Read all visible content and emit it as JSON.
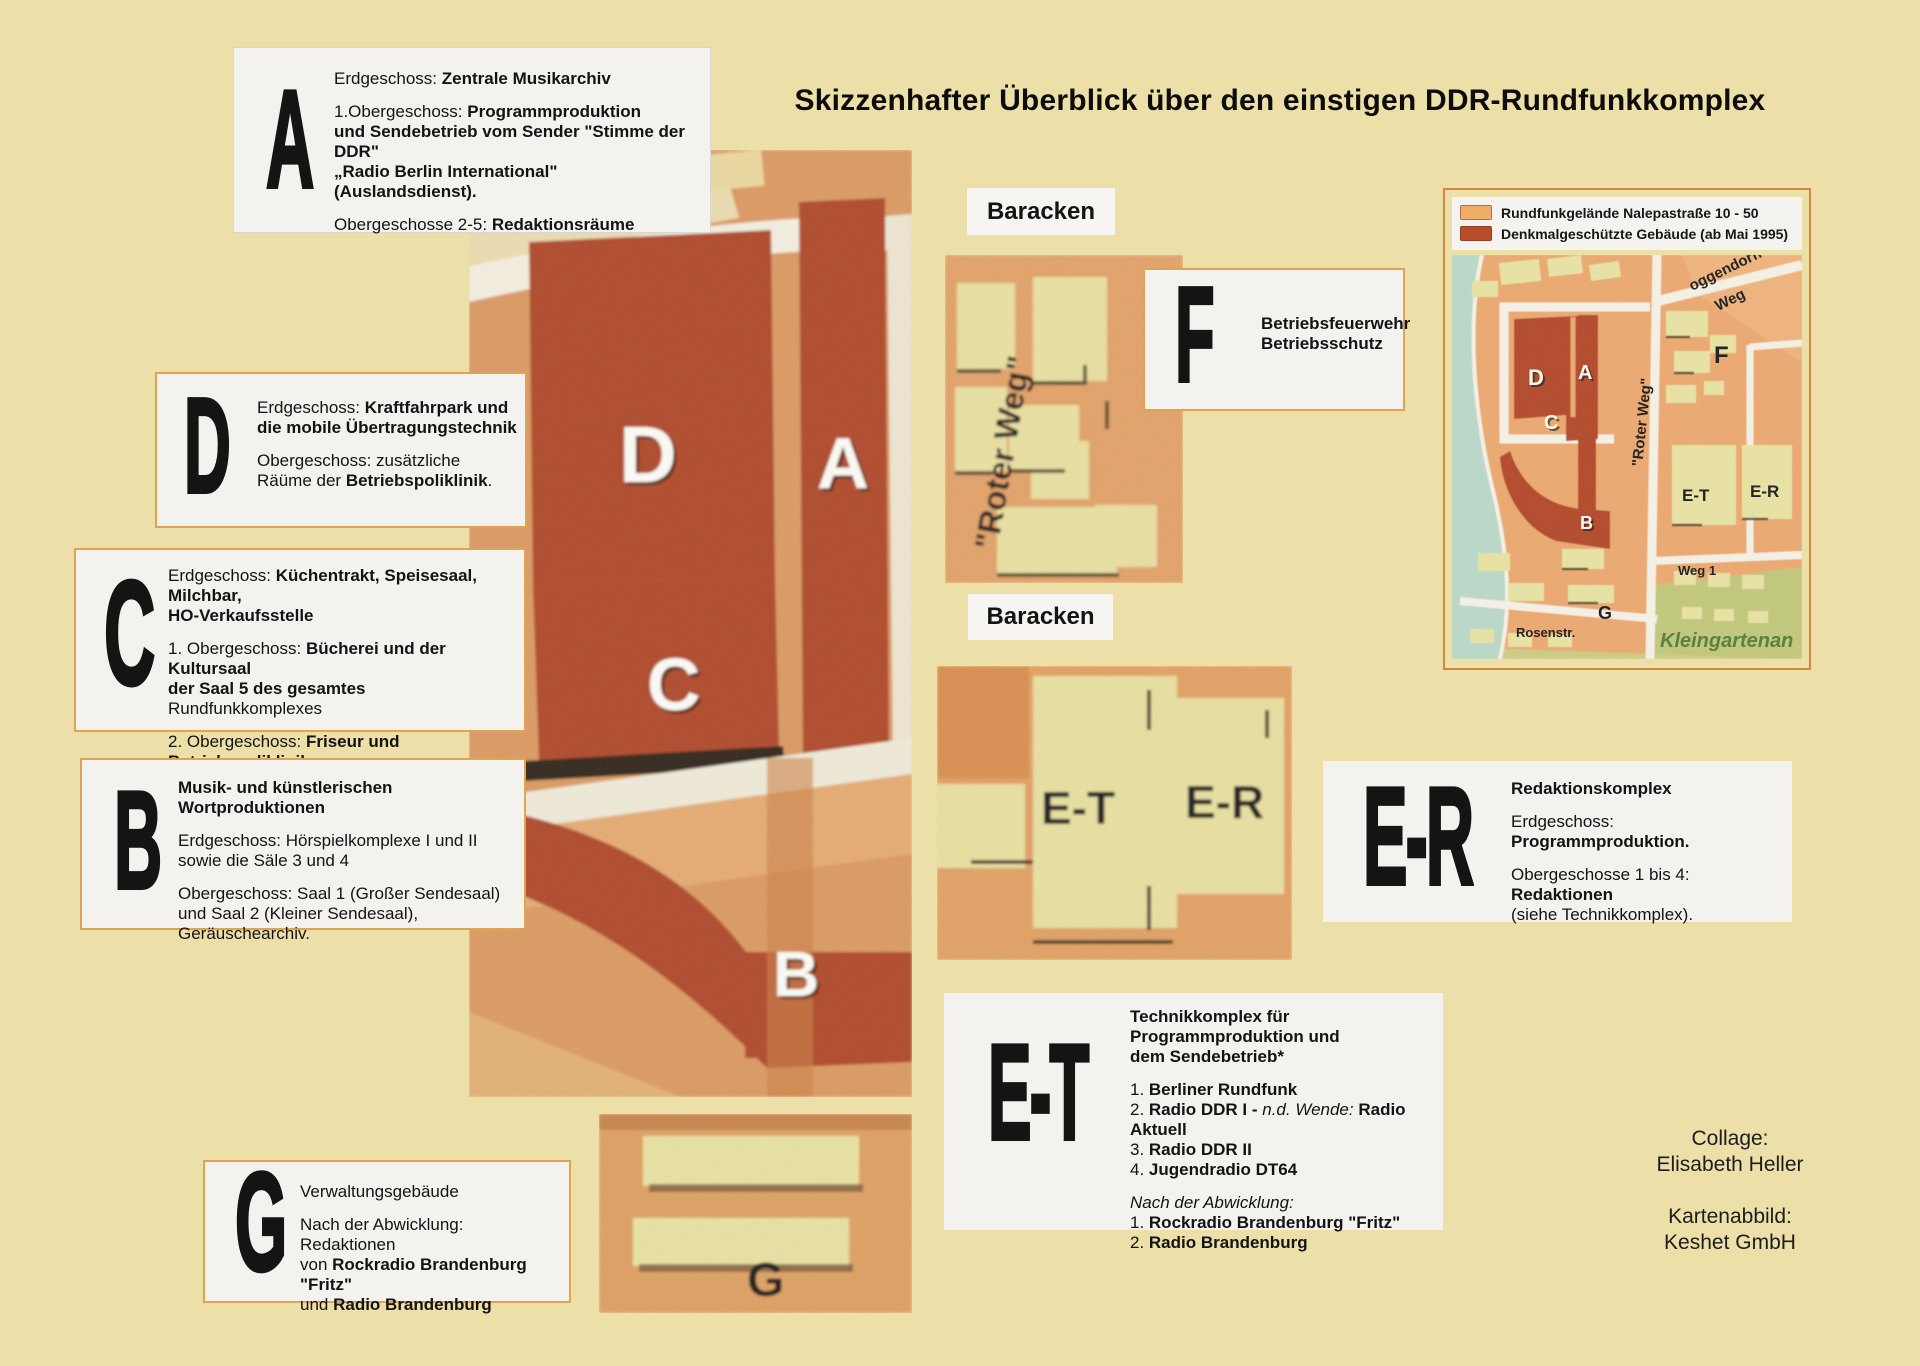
{
  "title": "Skizzenhafter Überblick über den einstigen DDR-Rundfunkkomplex",
  "colors": {
    "page_background": "#ecdfa8",
    "box_background": "#f3f2ee",
    "box_border_orange": "#dfa452",
    "map_orange": "#dc9a62",
    "building_red": "#b04a29",
    "building_yellow": "#e9e0a0",
    "water": "#bad9c9",
    "green_area": "#c3c87c"
  },
  "boxes": {
    "a": {
      "letter": "A",
      "paragraphs": [
        [
          [
            {
              "t": "Erdgeschoss: "
            },
            {
              "t": "Zentrale Musikarchiv",
              "b": true
            }
          ]
        ],
        [
          [
            {
              "t": "1.Obergeschoss: "
            },
            {
              "t": "Programmproduktion",
              "b": true
            }
          ],
          [
            {
              "t": "und Sendebetrieb vom Sender \"Stimme der DDR\"",
              "b": true
            }
          ],
          [
            {
              "t": " „Radio Berlin International\" (Auslandsdienst).",
              "b": true
            }
          ]
        ],
        [
          [
            {
              "t": "Obergeschosse 2-5: "
            },
            {
              "t": "Redaktionsräume",
              "b": true
            }
          ]
        ]
      ]
    },
    "d": {
      "letter": "D",
      "paragraphs": [
        [
          [
            {
              "t": "Erdgeschoss: "
            },
            {
              "t": "Kraftfahrpark und",
              "b": true
            }
          ],
          [
            {
              "t": "die mobile Übertragungstechnik",
              "b": true
            }
          ]
        ],
        [
          [
            {
              "t": "Obergeschoss: zusätzliche"
            }
          ],
          [
            {
              "t": "Räüme der "
            },
            {
              "t": "Betriebspoliklinik",
              "b": true
            },
            {
              "t": "."
            }
          ]
        ]
      ]
    },
    "c": {
      "letter": "C",
      "paragraphs": [
        [
          [
            {
              "t": "Erdgeschoss: "
            },
            {
              "t": "Küchentrakt, Speisesaal, Milchbar,",
              "b": true
            }
          ],
          [
            {
              "t": "HO-Verkaufsstelle",
              "b": true
            }
          ]
        ],
        [
          [
            {
              "t": "1. Obergeschoss: "
            },
            {
              "t": "Bücherei und der Kultursaal",
              "b": true
            }
          ],
          [
            {
              "t": " der Saal 5 des gesamtes",
              "b": true
            },
            {
              "t": " Rundfunkkomplexes"
            }
          ]
        ],
        [
          [
            {
              "t": "2. Obergeschoss: "
            },
            {
              "t": "Friseur und Betriebspoliklinik",
              "b": true
            }
          ]
        ]
      ]
    },
    "b": {
      "letter": "B",
      "paragraphs": [
        [
          [
            {
              "t": "Musik- und künstlerischen Wortproduktionen",
              "b": true
            }
          ]
        ],
        [
          [
            {
              "t": "Erdgeschoss: Hörspielkomplexe I und II"
            }
          ],
          [
            {
              "t": "sowie die Säle 3 und 4"
            }
          ]
        ],
        [
          [
            {
              "t": "Obergeschoss: Saal 1 (Großer Sendesaal)"
            }
          ],
          [
            {
              "t": "und Saal 2 (Kleiner Sendesaal), Geräuschearchiv."
            }
          ]
        ]
      ]
    },
    "g": {
      "letter": "G",
      "paragraphs": [
        [
          [
            {
              "t": "Verwaltungsgebäude"
            }
          ]
        ],
        [
          [
            {
              "t": "Nach der Abwicklung: Redaktionen"
            }
          ],
          [
            {
              "t": "von "
            },
            {
              "t": "Rockradio Brandenburg \"Fritz\"",
              "b": true
            }
          ],
          [
            {
              "t": "und "
            },
            {
              "t": "Radio Brandenburg",
              "b": true
            }
          ]
        ]
      ]
    },
    "f": {
      "letter": "F",
      "paragraphs": [
        [
          [
            {
              "t": "Betriebsfeuerwehr",
              "b": true
            }
          ],
          [
            {
              "t": "Betriebsschutz",
              "b": true
            }
          ]
        ]
      ]
    },
    "er": {
      "letter": "E-R",
      "paragraphs": [
        [
          [
            {
              "t": "Redaktionskomplex",
              "b": true
            }
          ]
        ],
        [
          [
            {
              "t": "Erdgeschoss: "
            },
            {
              "t": "Programmproduktion.",
              "b": true
            }
          ]
        ],
        [
          [
            {
              "t": "Obergeschosse 1 bis 4: "
            },
            {
              "t": "Redaktionen",
              "b": true
            }
          ],
          [
            {
              "t": "(siehe Technikkomplex)."
            }
          ]
        ]
      ]
    },
    "et": {
      "letter": "E-T",
      "paragraphs": [
        [
          [
            {
              "t": "Technikkomplex  für  Programmproduktion und",
              "b": true
            }
          ],
          [
            {
              "t": "dem Sendebetrieb*",
              "b": true
            }
          ]
        ],
        [
          [
            {
              "t": "1. "
            },
            {
              "t": "Berliner Rundfunk",
              "b": true
            }
          ],
          [
            {
              "t": "2. "
            },
            {
              "t": "Radio DDR I - ",
              "b": true
            },
            {
              "t": "n.d. Wende: ",
              "i": true
            },
            {
              "t": "Radio Aktuell",
              "b": true
            }
          ],
          [
            {
              "t": "3. "
            },
            {
              "t": "Radio DDR II",
              "b": true
            }
          ],
          [
            {
              "t": "4. "
            },
            {
              "t": "Jugendradio DT64",
              "b": true
            }
          ]
        ],
        [
          [
            {
              "t": "Nach der Abwicklung:",
              "i": true
            }
          ],
          [
            {
              "t": "1. "
            },
            {
              "t": "Rockradio Brandenburg \"Fritz\"",
              "b": true
            }
          ],
          [
            {
              "t": "2. "
            },
            {
              "t": "Radio Brandenburg",
              "b": true
            }
          ]
        ]
      ]
    }
  },
  "baracken_top": "Baracken",
  "baracken_bottom": "Baracken",
  "central_map": {
    "letters": {
      "d": "D",
      "a": "A",
      "c": "C",
      "b": "B"
    }
  },
  "roter_weg_strip": {
    "label": "\"Roter Weg\""
  },
  "eter_map": {
    "et": "E-T",
    "er": "E-R"
  },
  "g_map": {
    "letter": "G"
  },
  "inset": {
    "legend": [
      {
        "swatch": "#efae67",
        "label": "Rundfunkgelände Nalepastraße 10 - 50"
      },
      {
        "swatch": "#b94a2b",
        "label": "Denkmalgeschützte Gebäude (ab Mai 1995)"
      }
    ],
    "labels": {
      "poggendorff_line1": "oggendorff-",
      "poggendorff_line2": "Weg",
      "roter_weg": "\"Roter Weg\"",
      "d": "D",
      "a": "A",
      "c": "C",
      "b": "B",
      "f": "F",
      "et": "E-T",
      "er": "E-R",
      "weg1": "Weg 1",
      "g": "G",
      "rosenstr": "Rosenstr.",
      "kleingarten": "Kleingartenan"
    }
  },
  "credits": {
    "line1_label": "Collage:",
    "line1_name": "Elisabeth Heller",
    "line2_label": "Kartenabbild:",
    "line2_name": "Keshet GmbH"
  }
}
